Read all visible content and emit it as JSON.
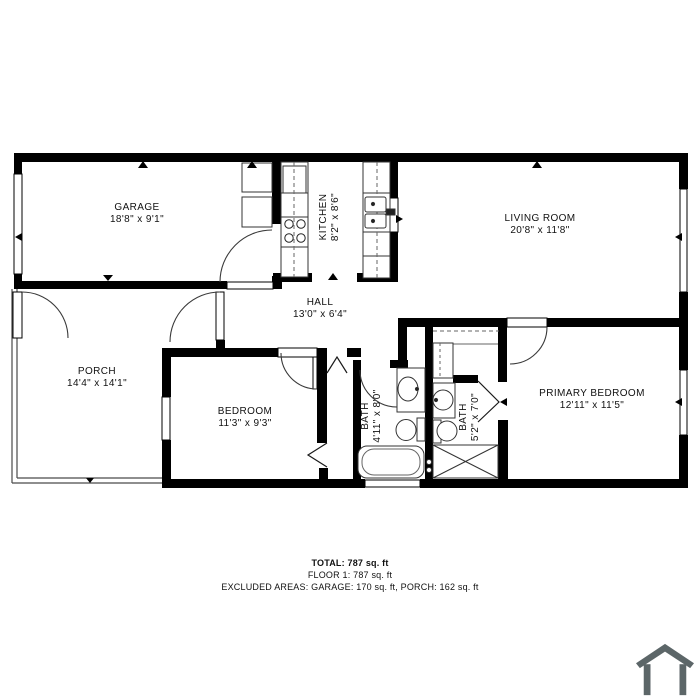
{
  "colors": {
    "wall": "#000000",
    "background": "#ffffff",
    "thin_line": "#3a3a3a",
    "house_icon": "#5c6668"
  },
  "rooms": {
    "garage": {
      "name": "GARAGE",
      "dims": "18'8\" x 9'1\""
    },
    "kitchen": {
      "name": "KITCHEN",
      "dims": "8'2\" x 8'6\""
    },
    "living_room": {
      "name": "LIVING ROOM",
      "dims": "20'8\" x 11'8\""
    },
    "hall": {
      "name": "HALL",
      "dims": "13'0\" x 6'4\""
    },
    "porch": {
      "name": "PORCH",
      "dims": "14'4\" x 14'1\""
    },
    "bedroom": {
      "name": "BEDROOM",
      "dims": "11'3\" x 9'3\""
    },
    "bath1": {
      "name": "BATH",
      "dims": "4'11\" x 8'0\""
    },
    "bath2": {
      "name": "BATH",
      "dims": "5'2\" x 7'0\""
    },
    "primary_bedroom": {
      "name": "PRIMARY BEDROOM",
      "dims": "12'11\" x 11'5\""
    }
  },
  "summary": {
    "total": "TOTAL: 787 sq. ft",
    "floor1": "FLOOR 1: 787 sq. ft",
    "excluded": "EXCLUDED AREAS: GARAGE: 170 sq. ft, PORCH: 162 sq. ft"
  }
}
